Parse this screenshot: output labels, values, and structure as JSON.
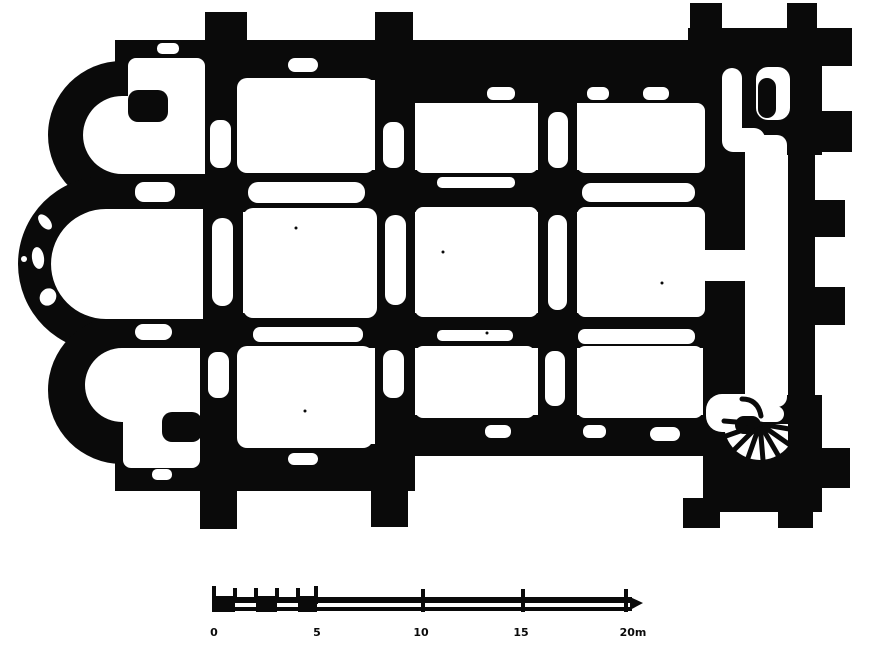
{
  "figure": {
    "paper_color": "#ffffff",
    "ink_color": "#0a0a0a"
  },
  "scale_bar": {
    "labels": [
      "0",
      "5",
      "10",
      "15",
      "20m"
    ]
  }
}
